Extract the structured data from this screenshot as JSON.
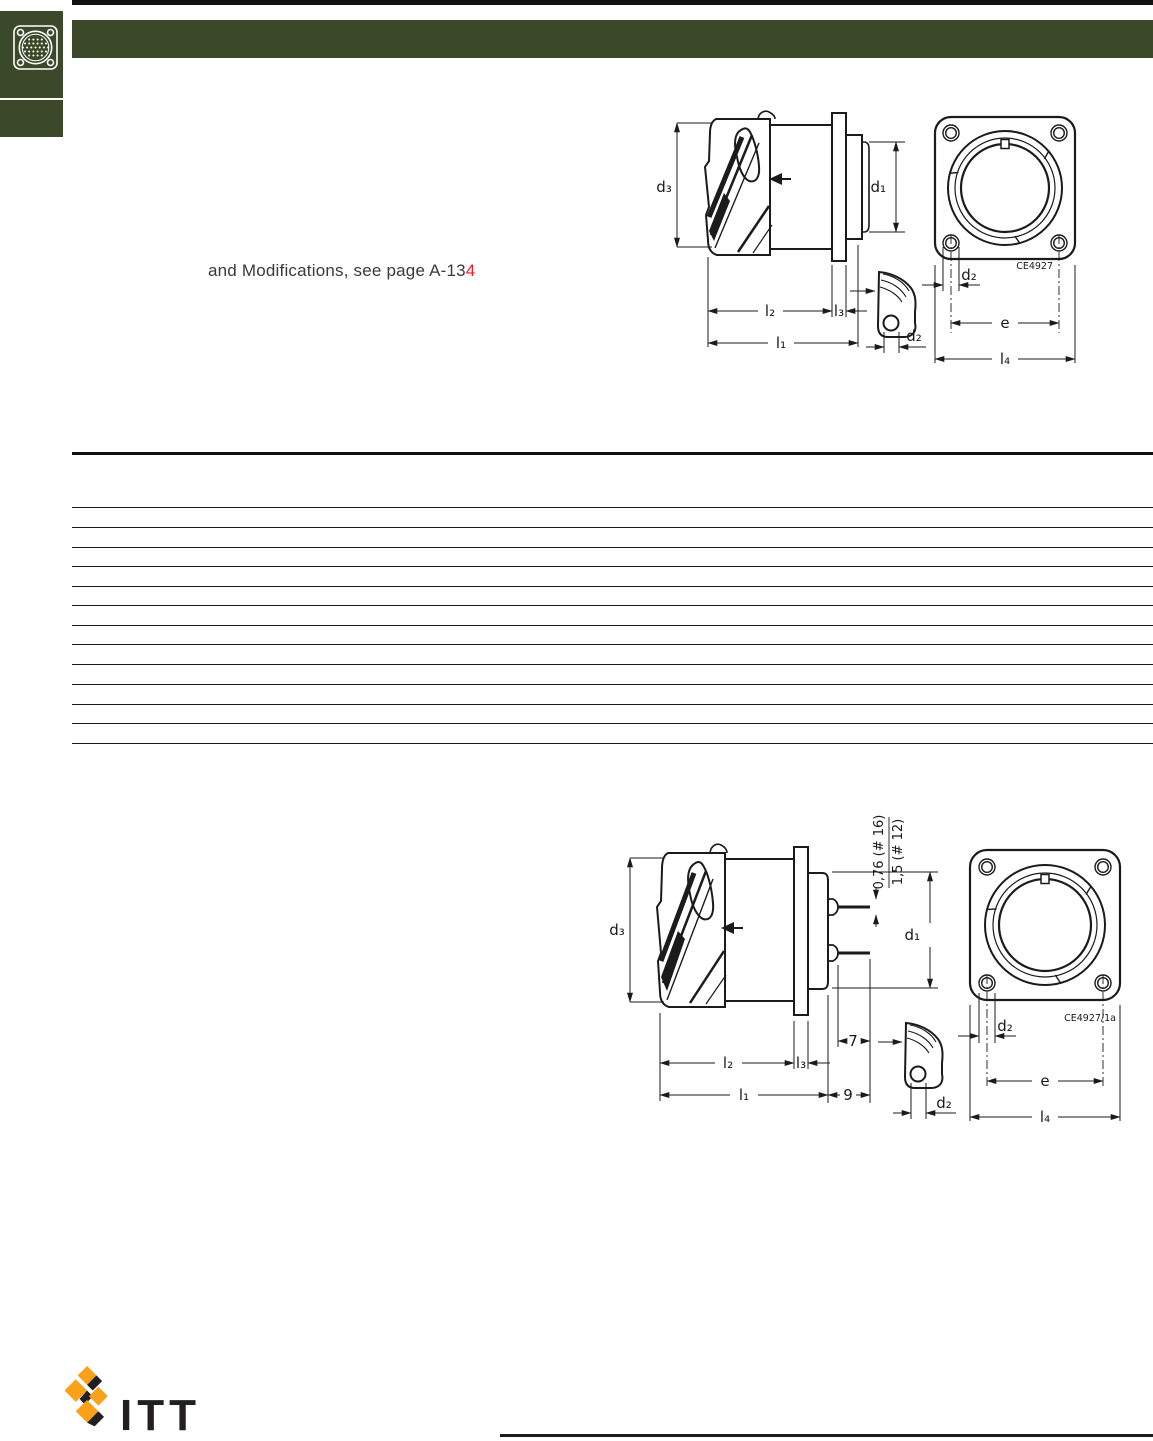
{
  "note": {
    "prefix": "and Modifications, see page A-13",
    "highlight": "4"
  },
  "logo": {
    "wordmark": "ITT"
  },
  "colors": {
    "header_green": "#3B4829",
    "note_red": "#ED1C24",
    "logo_orange": "#F9A11B",
    "logo_black": "#231F20",
    "line_black": "#1b1b1b"
  },
  "icons": {
    "sidebar_icon": "connector-face-icon"
  },
  "drawing_top": {
    "code": "CE4927",
    "labels": {
      "d3": "d₃",
      "d1": "d₁",
      "l2": "l₂",
      "l3": "l₃",
      "l1": "l₁",
      "d2_detail": "d₂",
      "d2_front": "d₂",
      "e": "e",
      "l4": "l₄"
    }
  },
  "drawing_bottom": {
    "code": "CE4927/1a",
    "labels": {
      "d3": "d₃",
      "d1": "d₁",
      "l2": "l₂",
      "l3": "l₃",
      "l1": "l₁",
      "d2_detail": "d₂",
      "d2_front": "d₂",
      "e": "e",
      "l4": "l₄",
      "tail_len": "7",
      "overall_len": "9",
      "dia_16": "0,76 (# 16)",
      "dia_12": "1,5 (# 12)"
    }
  }
}
